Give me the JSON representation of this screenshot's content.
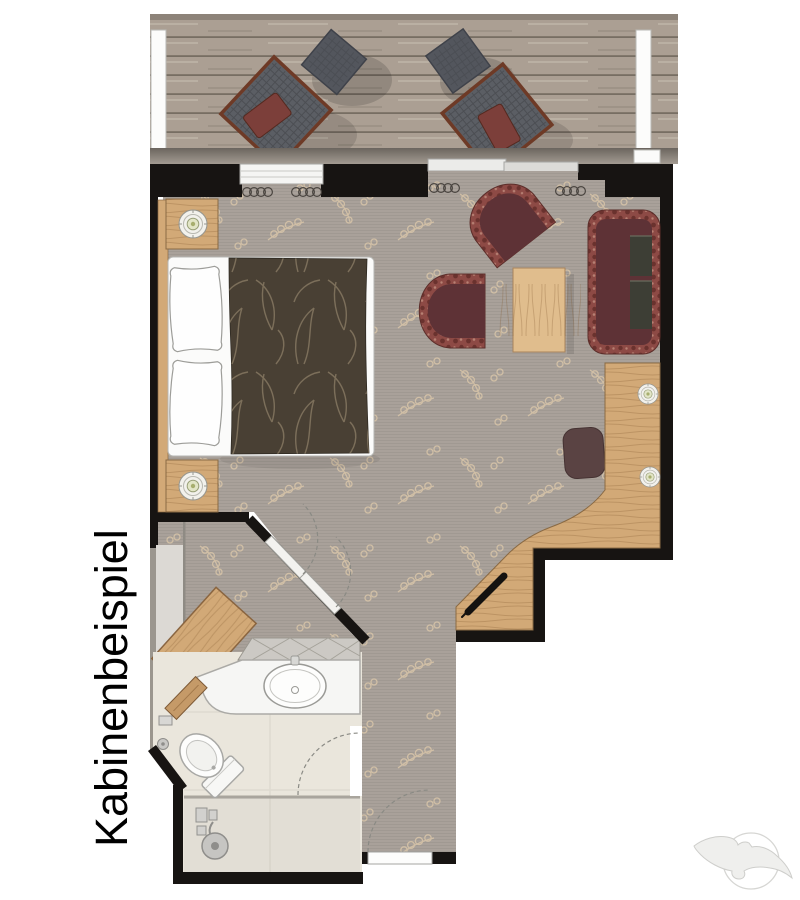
{
  "caption": {
    "text": "Kabinenbeispiel"
  },
  "watermark": {
    "icon": "seagull-logo"
  },
  "plan": {
    "type": "cruise-ship-cabin-floor-plan",
    "areas": {
      "balcony": {
        "items": [
          "deck-lounger",
          "deck-side-table",
          "deck-lounger",
          "deck-side-table",
          "railing"
        ]
      },
      "cabin": {
        "items": [
          "double-bed",
          "pillow",
          "pillow",
          "duvet",
          "nightstand",
          "nightstand",
          "nightstand-lamp",
          "nightstand-lamp",
          "tub-chair",
          "tub-chair",
          "coffee-table",
          "sofa",
          "stool",
          "desk",
          "desk-lamp",
          "desk-lamp",
          "console",
          "wardrobe",
          "curtains"
        ]
      },
      "bathroom": {
        "items": [
          "vanity-counter",
          "washbasin",
          "toilet",
          "shower",
          "towel-rail"
        ]
      },
      "corridor": {
        "items": [
          "entry-door",
          "bathroom-door"
        ]
      }
    },
    "openings": [
      "window",
      "balcony-sliding-door",
      "bedroom-double-door",
      "bathroom-door",
      "entry-door"
    ]
  },
  "colors": {
    "wall": "#171412",
    "carpet": "#a9a19a",
    "carpetleaf": "#d8c5a8",
    "tiles": "#eae6dc",
    "wood": "#d2a977",
    "woodlight": "#e0bd8d",
    "deck": "#ab9f93",
    "duvet": "#494034",
    "fern": "#8d7e67",
    "rim": "#8d4a45",
    "rimdark": "#6a322e",
    "seat": "#5e3236",
    "sofacushion": "#3d3e35",
    "wicker": "#5b5e64",
    "frame": "#6e3a26",
    "cushion": "#7c3f3a"
  }
}
